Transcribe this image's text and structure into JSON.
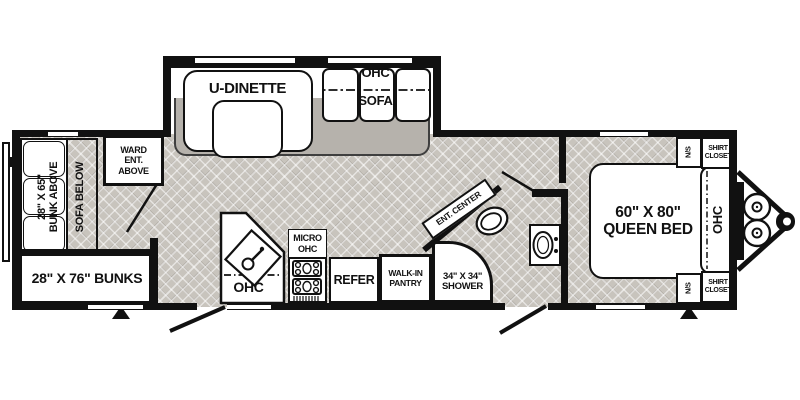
{
  "floorplan": {
    "rear": {
      "bunk_size": "28\" X 65\"",
      "bunk_above": "BUNK ABOVE",
      "sofa_below": "SOFA BELOW",
      "bunks": "28\" X 76\" BUNKS",
      "ward": [
        "WARD",
        "ENT.",
        "ABOVE"
      ]
    },
    "slide": {
      "dinette": "U-DINETTE",
      "ohc": "OHC",
      "sofa": "SOFA"
    },
    "kitchen": {
      "ohc": "OHC",
      "micro": [
        "MICRO",
        "OHC"
      ],
      "refer": "REFER",
      "pantry": [
        "WALK-IN",
        "PANTRY"
      ]
    },
    "bath": {
      "shower": [
        "34\" X 34\"",
        "SHOWER"
      ],
      "ent_center": "ENT. CENTER"
    },
    "bedroom": {
      "bed": [
        "60\" X 80\"",
        "QUEEN BED"
      ],
      "ohc": "OHC",
      "ns_top": "N/S",
      "ns_bottom": "N/S",
      "closet_top": [
        "SHIRT",
        "CLOSET"
      ],
      "closet_bottom": [
        "SHIRT",
        "CLOSET"
      ]
    },
    "colors": {
      "wall": "#111111",
      "floor": "#c8c4bd",
      "slide_floor": "#b6b2ac",
      "furniture": "#ffffff"
    }
  }
}
